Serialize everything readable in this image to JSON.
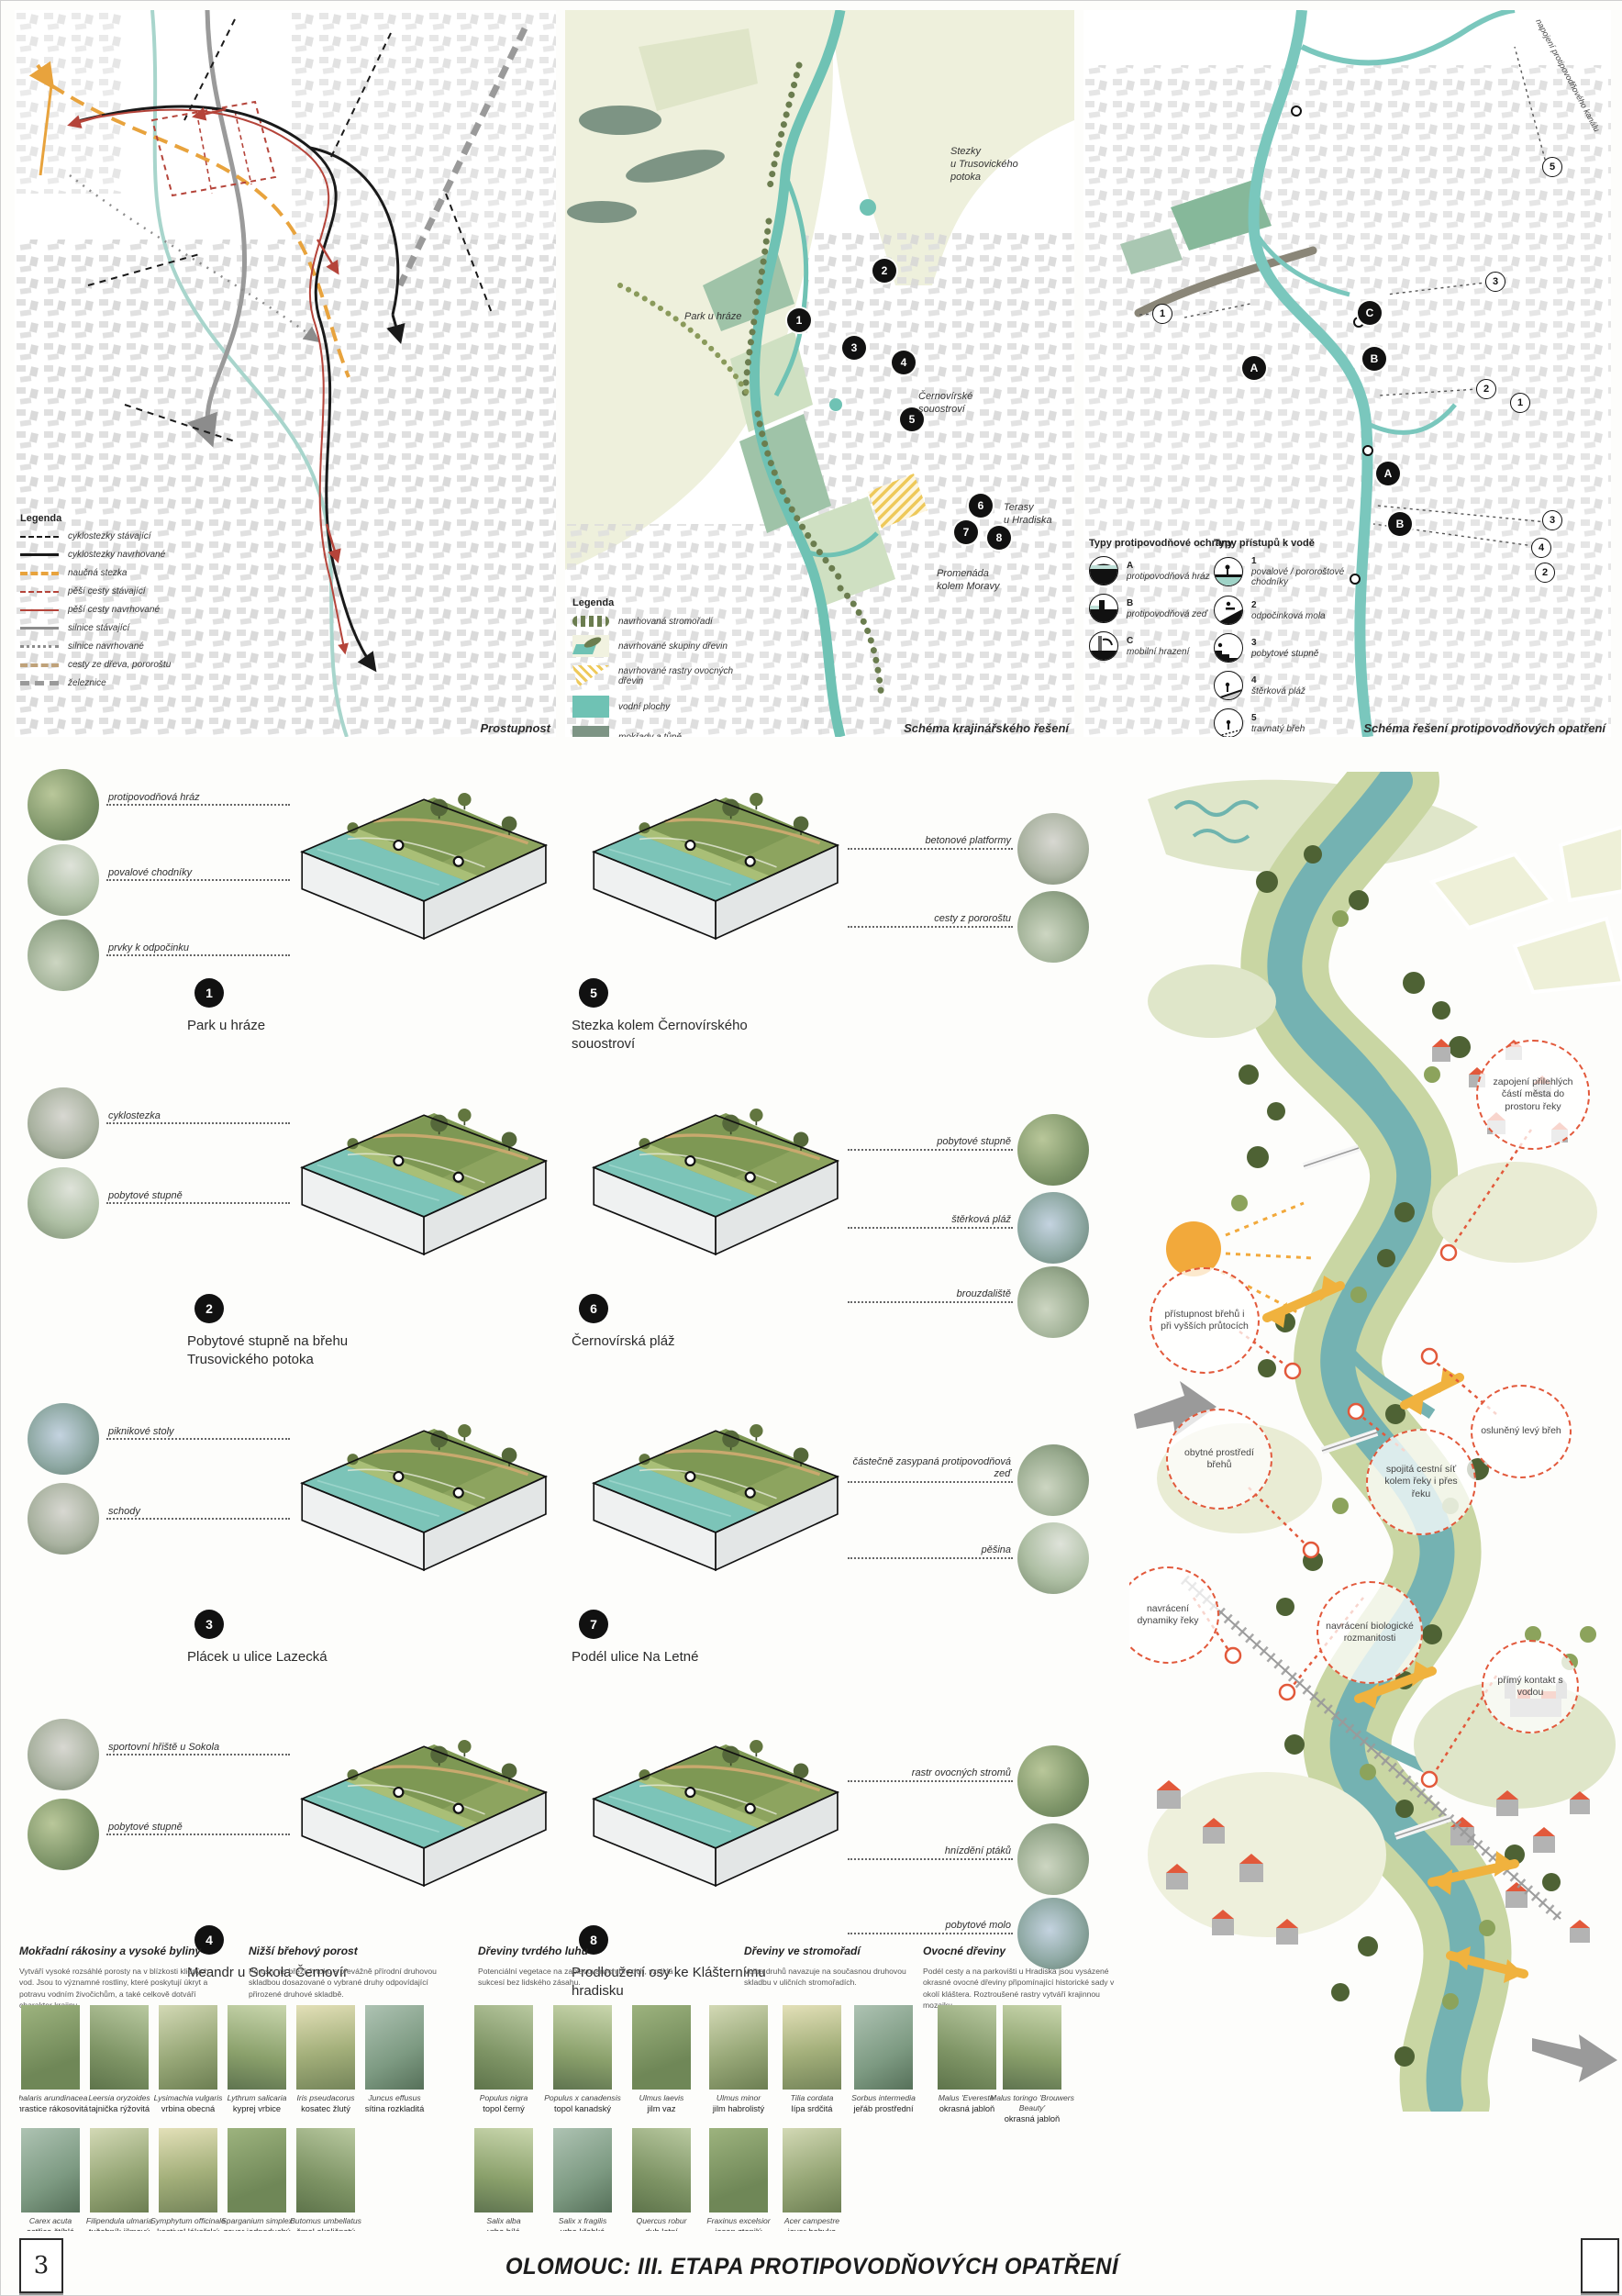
{
  "page": {
    "number": "3",
    "title": "OLOMOUC: III. ETAPA PROTIPOVODŇOVÝCH OPATŘENÍ"
  },
  "colors": {
    "river": "#6fc2b4",
    "wetland": "#7d9484",
    "accent_orange": "#e8a33d",
    "callout_red": "#e2593b",
    "path_red": "#b5443a",
    "roof_red": "#e2593b",
    "arrow_yellow": "#f0b23e"
  },
  "maps": {
    "map1": {
      "caption": "Prostupnost",
      "legend_title": "Legenda",
      "legend": [
        "cyklostezky stávající",
        "cyklostezky navrhované",
        "naučná stezka",
        "pěší cesty stávající",
        "pěší cesty navrhované",
        "silnice stávající",
        "silnice navrhované",
        "cesty ze dřeva, pororoštu",
        "železnice"
      ]
    },
    "map2": {
      "caption": "Schéma krajinářského řešení",
      "legend_title": "Legenda",
      "legend": [
        "navrhovaná stromořadí",
        "navrhované skupiny dřevin",
        "navrhované rastry ovocných dřevin",
        "vodní plochy",
        "mokřady a tůně"
      ],
      "labels": [
        "Stezky\nu Trusovického\npotoka",
        "Park u hráze",
        "Černovírské\nsouostroví",
        "Terasy\nu Hradiska",
        "Promenáda\nkolem Moravy"
      ],
      "markers": [
        "1",
        "2",
        "3",
        "4",
        "5",
        "6",
        "7",
        "8"
      ]
    },
    "map3": {
      "caption": "Schéma řešení protipovodňových opatření",
      "edge_label": "napojení protipovodňového kanálu",
      "legend_a_title": "Typy protipovodňové ochrany",
      "legend_a": [
        {
          "k": "A",
          "label": "protipovodňová hráz"
        },
        {
          "k": "B",
          "label": "protipovodňová zeď"
        },
        {
          "k": "C",
          "label": "mobilní hrazení"
        }
      ],
      "legend_b_title": "Typy přístupů k vodě",
      "legend_b": [
        {
          "k": "1",
          "label": "povalové / pororoštové chodníky"
        },
        {
          "k": "2",
          "label": "odpočinková mola"
        },
        {
          "k": "3",
          "label": "pobytové stupně"
        },
        {
          "k": "4",
          "label": "štěrková pláž"
        },
        {
          "k": "5",
          "label": "travnatý břeh"
        }
      ],
      "letters": [
        "A",
        "C",
        "B",
        "A",
        "B"
      ],
      "nums": [
        "5",
        "3",
        "1",
        "2",
        "1",
        "3",
        "4",
        "2"
      ]
    }
  },
  "diagrams": [
    {
      "num": "1",
      "caption": "Park u hráze",
      "callouts": [
        "protipovodňová hráz",
        "povalové chodníky",
        "prvky k odpočinku"
      ]
    },
    {
      "num": "2",
      "caption": "Pobytové stupně na břehu Trusovického potoka",
      "callouts": [
        "cyklostezka",
        "pobytové stupně"
      ]
    },
    {
      "num": "3",
      "caption": "Plácek u ulice Lazecká",
      "callouts": [
        "piknikové stoly",
        "schody"
      ]
    },
    {
      "num": "4",
      "caption": "Meandr u Sokola Černovír",
      "callouts": [
        "sportovní hřiště u Sokola",
        "pobytové stupně"
      ]
    },
    {
      "num": "5",
      "caption": "Stezka kolem Černovírského souostroví",
      "callouts": [
        "betonové platformy",
        "cesty z pororoštu"
      ]
    },
    {
      "num": "6",
      "caption": "Černovírská pláž",
      "callouts": [
        "pobytové stupně",
        "štěrková pláž",
        "brouzdaliště"
      ]
    },
    {
      "num": "7",
      "caption": "Podél ulice Na Letné",
      "callouts": [
        "částečně zasypaná protipovodňová zeď",
        "pěšina"
      ]
    },
    {
      "num": "8",
      "caption": "Prodloužení osy ke Klášternímu hradisku",
      "callouts": [
        "rastr ovocných stromů",
        "hnízdění ptáků",
        "pobytové molo"
      ]
    }
  ],
  "illustration": {
    "callouts": [
      "zapojení přilehlých částí města do prostoru řeky",
      "přístupnost břehů i při vyšších průtocích",
      "obytné prostředí břehů",
      "spojitá cestní síť kolem řeky i přes řeku",
      "osluněný levý břeh",
      "navrácení dynamiky řeky",
      "navrácení biologické rozmanitosti",
      "přímý kontakt s vodou"
    ]
  },
  "plants": {
    "groups": [
      {
        "title": "Mokřadní rákosiny a vysoké byliny",
        "text": "Vytváří vysoké rozsáhlé porosty na v blízkosti klidných vod. Jsou to významné rostliny, které poskytují úkryt a potravu vodním živočichům, a také celkově dotváří charakter krajiny."
      },
      {
        "title": "Nižší břehový porost",
        "text": "Porosty na březích toku s převážně přírodní druhovou skladbou dosazované o vybrané druhy odpovídající přirozené druhové skladbě."
      },
      {
        "title": "Dřeviny tvrdého luhu",
        "text": "Potenciální vegetace na zaplavovaných březích, vzniklá sukcesí bez lidského zásahu."
      },
      {
        "title": "Dřeviny ve stromořadí",
        "text": "Volba druhů navazuje na současnou druhovou skladbu v uličních stromořadích."
      },
      {
        "title": "Ovocné dřeviny",
        "text": "Podél cesty a na parkovišti u Hradiska jsou vysázené okrasné ovocné dřeviny připomínající historické sady v okolí kláštera. Roztroušené rastry vytváří krajinnou mozaiku."
      }
    ],
    "row1": [
      {
        "la": "Phalaris arundinacea",
        "cz": "chrastice rákosovitá"
      },
      {
        "la": "Leersia oryzoides",
        "cz": "tajnička rýžovitá"
      },
      {
        "la": "Lysimachia vulgaris",
        "cz": "vrbina obecná"
      },
      {
        "la": "Lythrum salicaria",
        "cz": "kyprej vrbice"
      },
      {
        "la": "Iris pseudacorus",
        "cz": "kosatec žlutý"
      },
      {
        "la": "Juncus effusus",
        "cz": "sítina rozkladitá"
      },
      {
        "la": "Populus nigra",
        "cz": "topol černý"
      },
      {
        "la": "Populus x canadensis",
        "cz": "topol kanadský"
      },
      {
        "la": "Ulmus laevis",
        "cz": "jilm vaz"
      },
      {
        "la": "Ulmus minor",
        "cz": "jilm habrolistý"
      },
      {
        "la": "Tilia cordata",
        "cz": "lípa srdčitá"
      },
      {
        "la": "Sorbus intermedia",
        "cz": "jeřáb prostřední"
      },
      {
        "la": "Malus 'Evereste'",
        "cz": "okrasná jabloň"
      },
      {
        "la": "Malus toringo 'Brouwers Beauty'",
        "cz": "okrasná jabloň"
      }
    ],
    "row2": [
      {
        "la": "Carex acuta",
        "cz": "ostřice štíhlá"
      },
      {
        "la": "Filipendula ulmaria",
        "cz": "tužebník jilmový"
      },
      {
        "la": "Symphytum officinale",
        "cz": "kostival lékařský"
      },
      {
        "la": "Sparganium simplex",
        "cz": "zevar jednoduchý"
      },
      {
        "la": "Butomus umbellatus",
        "cz": "šmel okoličnatý"
      },
      {
        "la": "Salix alba",
        "cz": "vrba bílá"
      },
      {
        "la": "Salix x fragilis",
        "cz": "vrba křehká"
      },
      {
        "la": "Quercus robur",
        "cz": "dub letní"
      },
      {
        "la": "Fraxinus excelsior",
        "cz": "jasan ztepilý"
      },
      {
        "la": "Acer campestre",
        "cz": "javor babyka"
      }
    ]
  }
}
